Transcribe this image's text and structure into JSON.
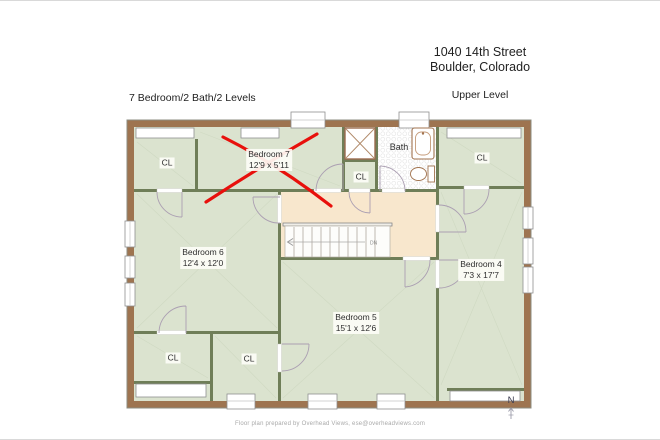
{
  "header": {
    "summary": "7 Bedroom/2 Bath/2 Levels",
    "address_line1": "1040 14th Street",
    "address_line2": "Boulder, Colorado",
    "level": "Upper Level"
  },
  "rooms": {
    "bedroom7": {
      "name": "Bedroom 7",
      "dims": "12'9 x 5'11",
      "crossed_out": true
    },
    "bedroom6": {
      "name": "Bedroom 6",
      "dims": "12'4 x 12'0"
    },
    "bedroom5": {
      "name": "Bedroom 5",
      "dims": "15'1 x 12'6"
    },
    "bedroom4": {
      "name": "Bedroom 4",
      "dims": "7'3 x 17'7"
    },
    "bath": {
      "name": "Bath"
    },
    "closet_label": "CL"
  },
  "stairs": {
    "down_label": "DN"
  },
  "compass": {
    "north": "N"
  },
  "footer": {
    "credit": "Floor plan prepared by Overhead Views, ese@overheadviews.com"
  },
  "colors": {
    "outer_wall": "#9e7450",
    "interior_wall": "#6f7e58",
    "room_fill": "#dbe3cf",
    "hall_fill": "#f8e7cd",
    "cross_out": "#e8100c",
    "door_arc": "#ab9fb2"
  }
}
